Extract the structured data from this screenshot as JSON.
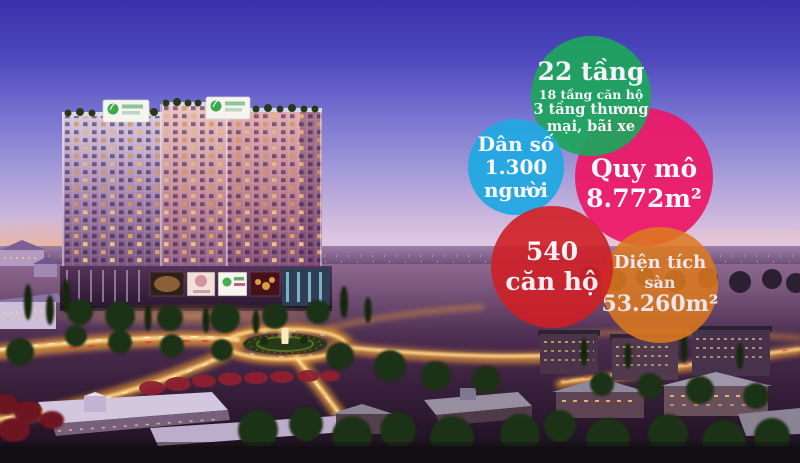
{
  "bubbles": [
    {
      "id": "floors",
      "color": "#1ea65c",
      "title": "22 tầng",
      "lines": [
        "18 tầng căn hộ",
        "3 tầng thương",
        "mại, bãi xe"
      ]
    },
    {
      "id": "population",
      "color": "#22a8e2",
      "lines": [
        "Dân số",
        "1.300",
        "người"
      ]
    },
    {
      "id": "scale",
      "color": "#ee1766",
      "lines": [
        "Quy mô",
        "8.772m²"
      ]
    },
    {
      "id": "apartments",
      "color": "#d02026",
      "lines": [
        "540",
        "căn hộ"
      ]
    },
    {
      "id": "floor-area",
      "color": "#de7a1e",
      "lines": [
        "Diện tích",
        "sàn",
        "53.260m²"
      ]
    }
  ],
  "scene": {
    "description_colors": {
      "sky_top": "#3931a9",
      "sky_horizon": "#eed9e3",
      "sunset_glow": "#ffb863",
      "road_lights": "#ffd98c",
      "foliage": "#1e3012",
      "bottom_bar": "#110f12"
    }
  }
}
